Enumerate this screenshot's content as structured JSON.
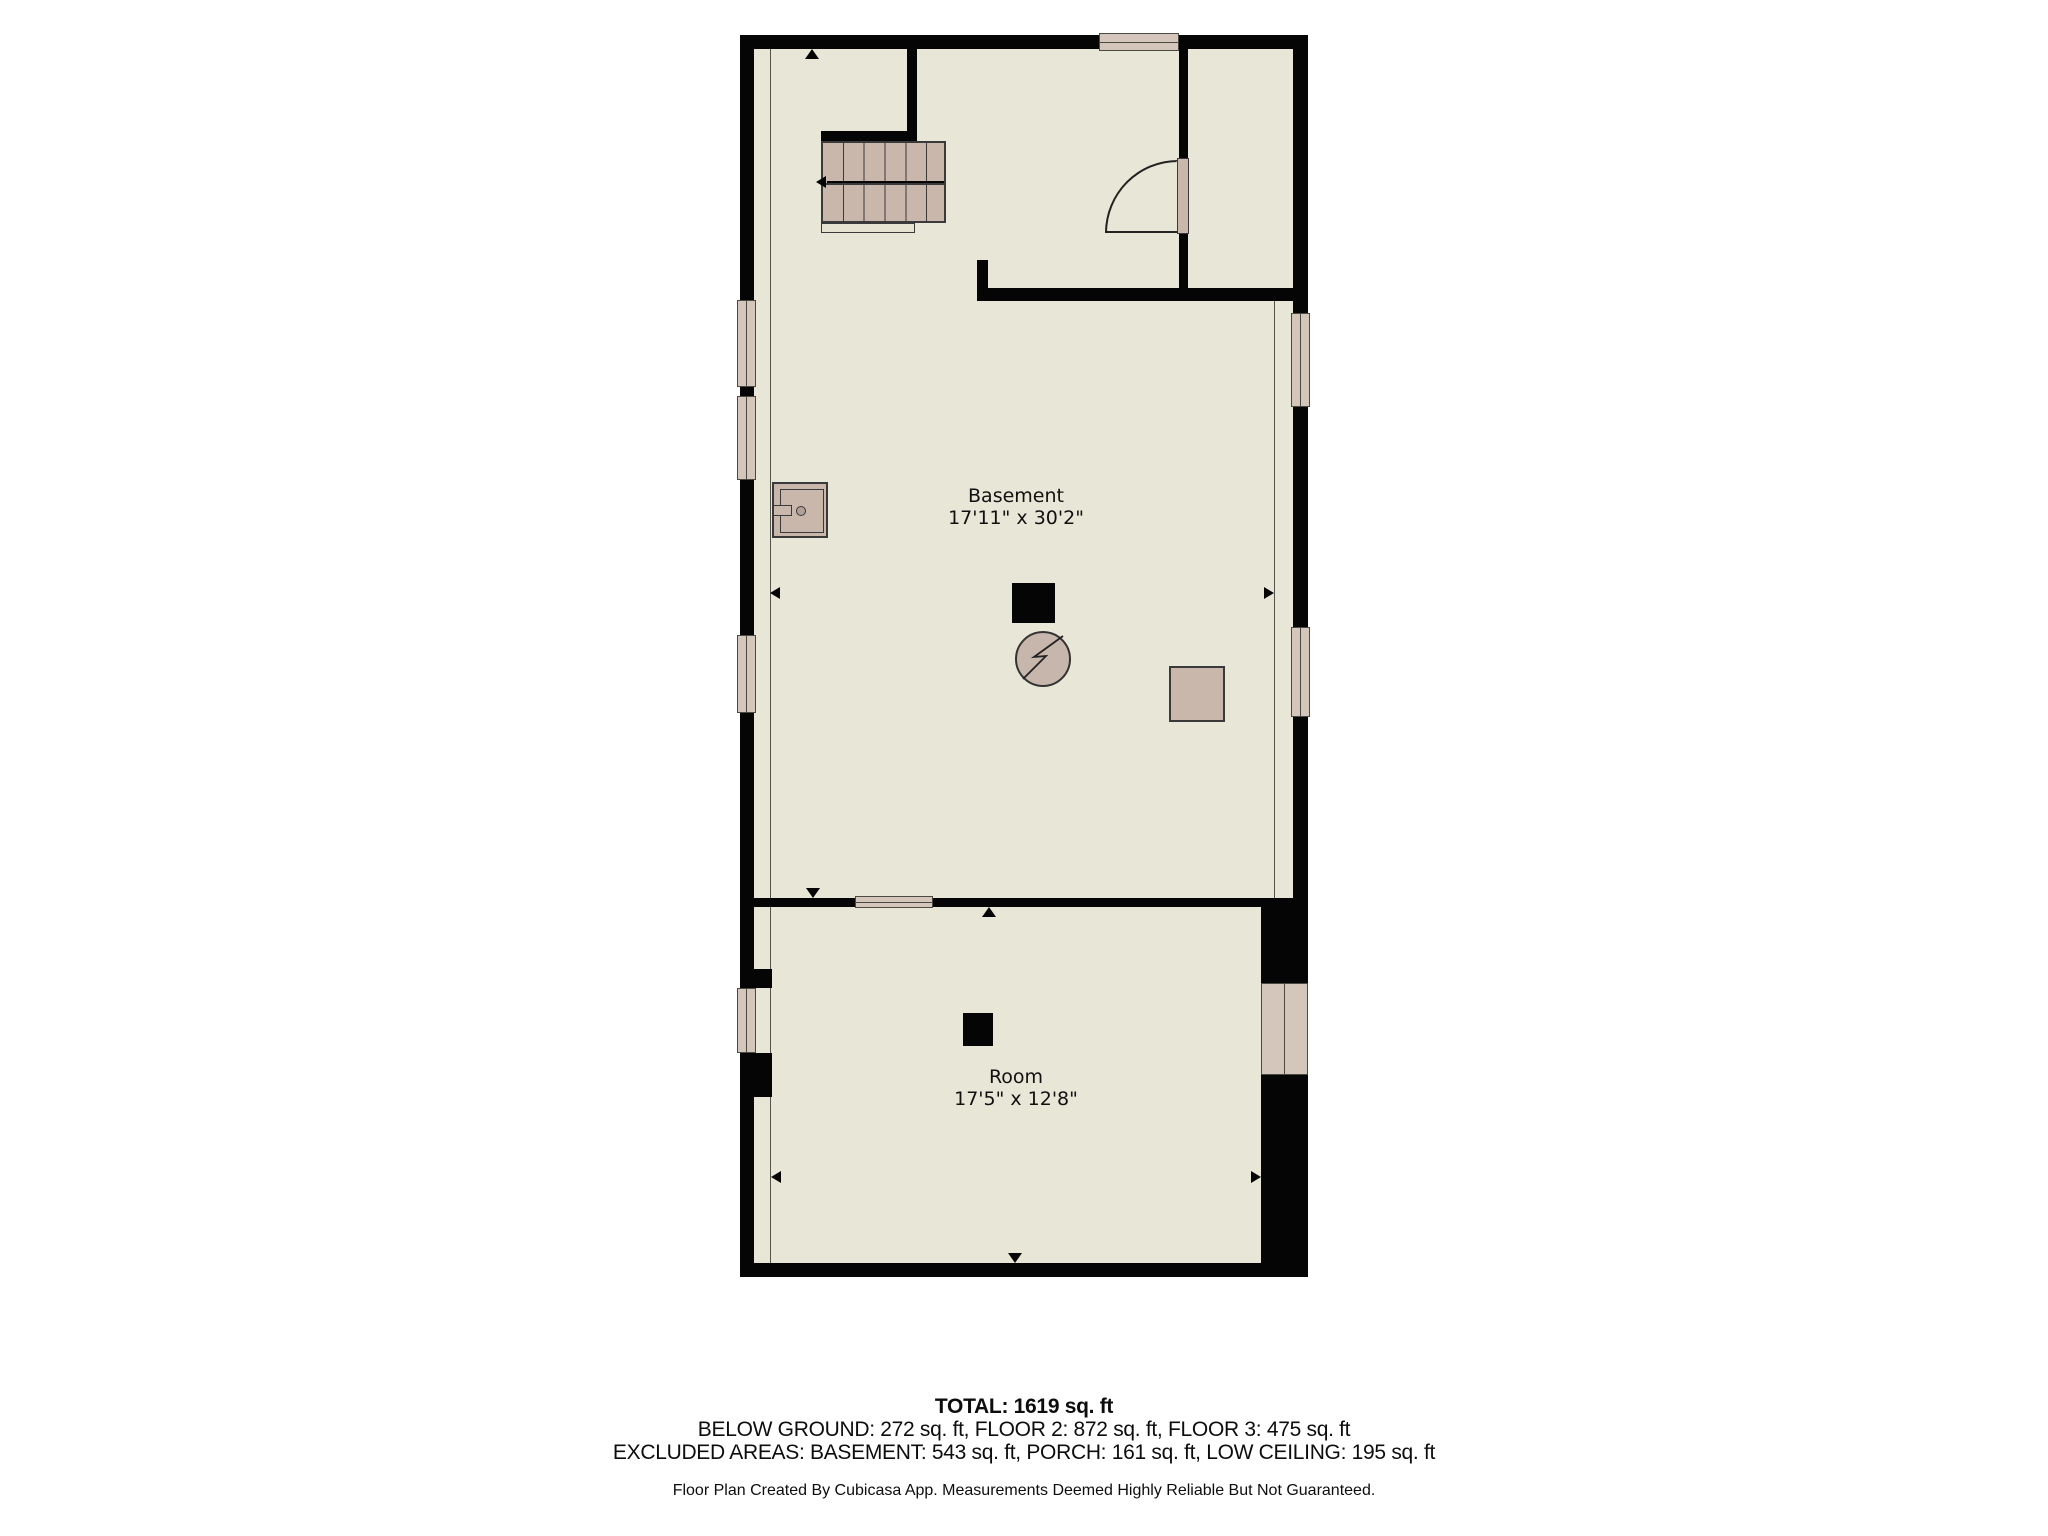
{
  "floor_plan": {
    "rooms": [
      {
        "name": "Basement",
        "dimensions": "17'11\" x 30'2\""
      },
      {
        "name": "Room",
        "dimensions": "17'5\" x 12'8\""
      }
    ],
    "summary": {
      "total": "TOTAL: 1619 sq. ft",
      "floors": "BELOW GROUND: 272 sq. ft, FLOOR 2: 872 sq. ft, FLOOR 3: 475 sq. ft",
      "excluded": "EXCLUDED AREAS: BASEMENT: 543 sq. ft, PORCH: 161 sq. ft, LOW CEILING: 195 sq. ft"
    },
    "disclaimer": "Floor Plan Created By Cubicasa App. Measurements Deemed Highly Reliable But Not Guaranteed.",
    "icons": {
      "electrical_panel": "circle-lightning-icon",
      "water_heater": "appliance-square-icon",
      "furnace": "black-square-icon",
      "equipment": "tan-square-icon",
      "stairs": "staircase-icon",
      "door": "door-swing-icon",
      "window": "window-icon"
    },
    "colors": {
      "background": "#ffffff",
      "floor": "#e8e6d6",
      "wall": "#050505",
      "fixture_tan": "#c9b7ac",
      "window_fill": "#d4c6ba",
      "text": "#111111"
    }
  }
}
